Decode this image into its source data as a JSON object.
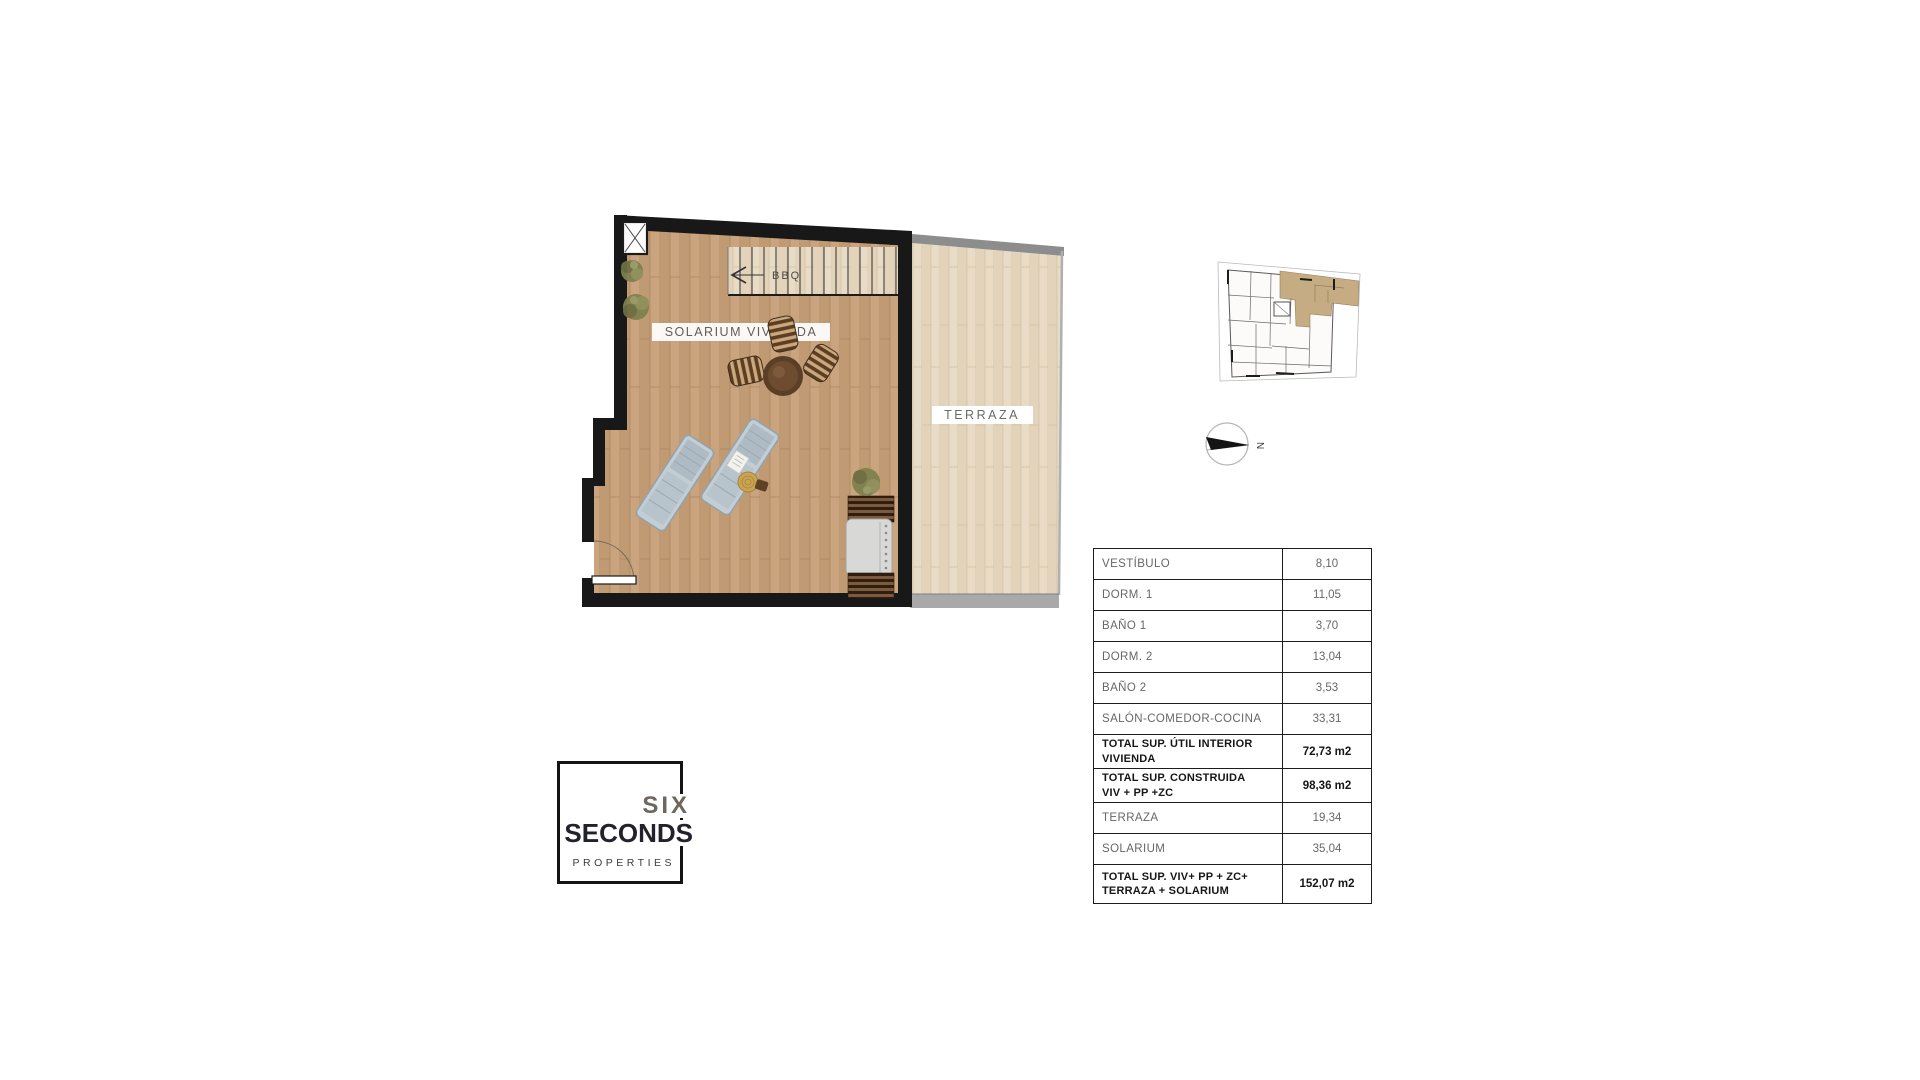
{
  "floor_plan": {
    "solarium_label": "SOLARIUM VIVIENDA",
    "terraza_label": "TERRAZA",
    "stairs_label": "BBQ"
  },
  "compass": {
    "north_label": "N"
  },
  "key_plan": {
    "highlight_color": "#c6ac83"
  },
  "colors": {
    "wall": "#181818",
    "solarium_floor": "#c9a47e",
    "terraza_floor": "#e9dcc6",
    "terraza_wall": "#8d8d8d",
    "terraza_base_band": "#a9a9a9"
  },
  "area_table": {
    "rows": [
      {
        "label": "VESTÍBULO",
        "value": "8,10",
        "bold": false
      },
      {
        "label": "DORM. 1",
        "value": "11,05",
        "bold": false
      },
      {
        "label": "BAÑO 1",
        "value": "3,70",
        "bold": false
      },
      {
        "label": "DORM. 2",
        "value": "13,04",
        "bold": false
      },
      {
        "label": "BAÑO 2",
        "value": "3,53",
        "bold": false
      },
      {
        "label": "SALÓN-COMEDOR-COCINA",
        "value": "33,31",
        "bold": false
      },
      {
        "label": "TOTAL SUP. ÚTIL INTERIOR\nVIVIENDA",
        "value": "72,73 m2",
        "bold": true
      },
      {
        "label": "TOTAL SUP. CONSTRUIDA\nVIV + PP +ZC",
        "value": "98,36 m2",
        "bold": true
      },
      {
        "label": "TERRAZA",
        "value": "19,34",
        "bold": false
      },
      {
        "label": "SOLARIUM",
        "value": "35,04",
        "bold": false
      },
      {
        "label": "TOTAL SUP. VIV+ PP + ZC+\nTERRAZA + SOLARIUM",
        "value": "152,07 m2",
        "bold": true
      }
    ]
  },
  "logo": {
    "word1": "SIX",
    "word2": "SECONDS",
    "word3": "PROPERTIES"
  }
}
